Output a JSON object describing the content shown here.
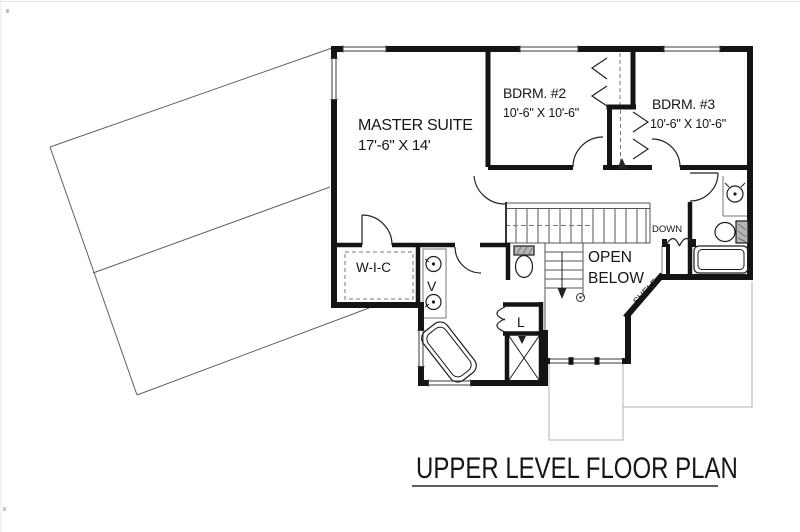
{
  "meta": {
    "background": "#ffffff",
    "ink": "#141414",
    "faint_line": "#5a5a5a",
    "lower_level_line": "#b0b0b0",
    "roof_line": "#606060"
  },
  "title": {
    "text": "UPPER LEVEL FLOOR PLAN"
  },
  "rooms": {
    "master": {
      "name": "MASTER SUITE",
      "dims": "17'-6\" X 14'"
    },
    "bdrm2": {
      "name": "BDRM. #2",
      "dims": "10'-6\" X 10'-6\""
    },
    "bdrm3": {
      "name": "BDRM. #3",
      "dims": "10'-6\" X 10'-6\""
    },
    "wic": {
      "name": "W-I-C"
    },
    "vanity": {
      "name": "V"
    },
    "linen": {
      "name": "L"
    },
    "open_below": {
      "line1": "OPEN",
      "line2": "BELOW"
    },
    "shelf": {
      "name": "SHELF"
    },
    "stairs": {
      "down_label": "DOWN"
    }
  }
}
